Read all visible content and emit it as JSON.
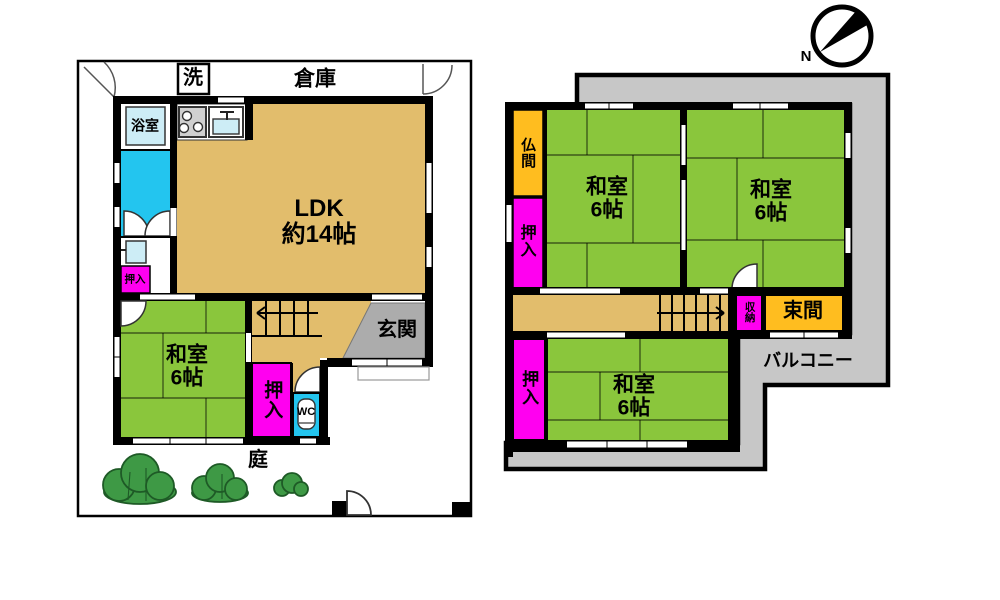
{
  "palette": {
    "wall": "#000000",
    "tan": "#e2bd6c",
    "green": "#8ac63c",
    "magenta": "#ff00f0",
    "cyan": "#23c5ef",
    "palecyan": "#cdedf6",
    "orange": "#ffbd1f",
    "balconygray": "#c7c7c7",
    "genkangray": "#acacac",
    "stovegray": "#d0d0d0",
    "bush": "#3e9945",
    "bushdark": "#1e5a26",
    "bg": "#ffffff"
  },
  "compass": {
    "north": "N"
  },
  "floor1": {
    "storage": "倉庫",
    "laundry": "洗",
    "bath": "浴室",
    "ldk_line1": "LDK",
    "ldk_line2": "約14帖",
    "closet_small": "押入",
    "washitsu_line1": "和室",
    "washitsu_line2": "6帖",
    "closet": "押入",
    "wc": "WC",
    "entrance": "玄関",
    "garden": "庭"
  },
  "floor2": {
    "altar_room": "仏間",
    "closet_north": "押入",
    "washitsu_nw_line1": "和室",
    "washitsu_nw_line2": "6帖",
    "washitsu_ne_line1": "和室",
    "washitsu_ne_line2": "6帖",
    "storage": "収納",
    "alcove": "束間",
    "closet_south": "押入",
    "washitsu_s_line1": "和室",
    "washitsu_s_line2": "6帖",
    "balcony": "バルコニー"
  }
}
